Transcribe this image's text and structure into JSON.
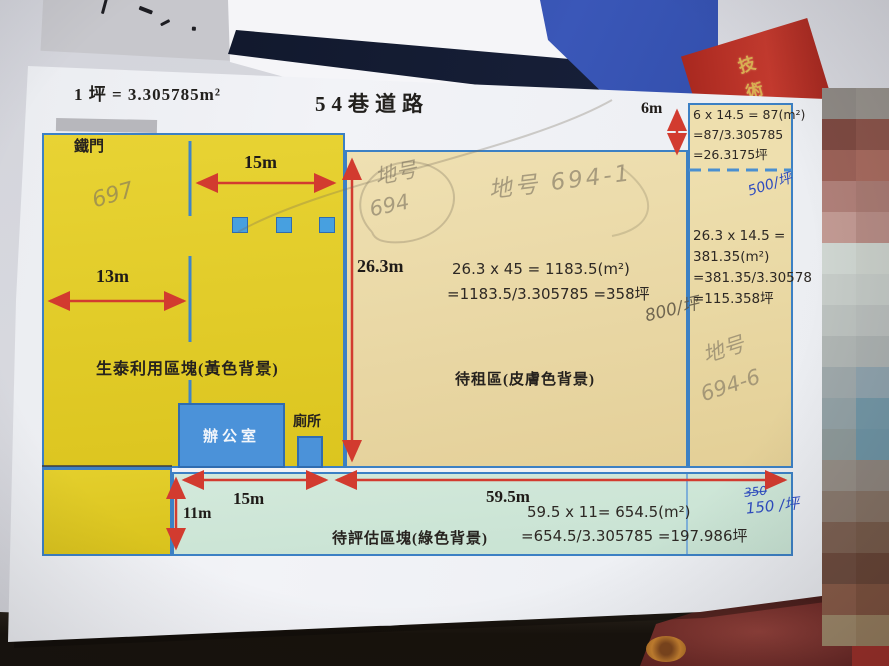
{
  "scene": {
    "banner_text": "技術顧",
    "mosaic_colors": [
      "#8f8a85",
      "#96918b",
      "#7e4a42",
      "#8a544a",
      "#9c6258",
      "#a66a5e",
      "#b08079",
      "#a87a72",
      "#c29a93",
      "#b58b84",
      "#cfd6d1",
      "#c9cfc9",
      "#c6ccc8",
      "#c2c8c4",
      "#bcc2bf",
      "#b8bdbb",
      "#b0b6b4",
      "#abb1b0",
      "#9fa9ab",
      "#8fa3ad",
      "#93a2a6",
      "#7397a6",
      "#8e9a9a",
      "#6e94a4",
      "#958e86",
      "#8e857d",
      "#8a7a6e",
      "#857264",
      "#7d6152",
      "#775b4a",
      "#6e4c3e",
      "#684536",
      "#8a5c48",
      "#7e523e",
      "#a08a6a",
      "#987f5e"
    ]
  },
  "header": {
    "unit_conversion": "1 坪 = 3.305785m²",
    "road_label": "54巷道路"
  },
  "plan": {
    "yellow_region": {
      "gate_label": "鐵門",
      "top_width": "15m",
      "left_width": "13m",
      "area_label": "生泰利用區塊(黃色背景)",
      "office_label": "辦公室",
      "toilet_label": "廁所",
      "hw_lot": "697"
    },
    "middle_region": {
      "height": "26.3m",
      "calc1": "26.3 x 45 = 1183.5(m²)",
      "calc2": "=1183.5/3.305785 =358坪",
      "area_label": "待租區(皮膚色背景)",
      "hw_lot_a1": "地号",
      "hw_lot_a2": "694",
      "hw_lot_b": "地号 694-1",
      "hw_price": "800/坪"
    },
    "right_region": {
      "height": "6m",
      "top_calc1": "6 x 14.5 = 87(m²)",
      "top_calc2": "=87/3.305785",
      "top_calc3": "=26.3175坪",
      "hw_price_top": "500/坪",
      "calc1": "26.3 x 14.5 =",
      "calc2": "381.35(m²)",
      "calc3": "=381.35/3.30578",
      "calc4": "=115.358坪",
      "hw_lot_1": "地号",
      "hw_lot_2": "694-6"
    },
    "green_region": {
      "height": "11m",
      "width_left": "15m",
      "width_right": "59.5m",
      "calc1": "59.5 x 11= 654.5(m²)",
      "calc2": "=654.5/3.305785 =197.986坪",
      "area_label": "待評估區塊(綠色背景)",
      "hw_price_old": "350",
      "hw_price_new": "150 /坪"
    }
  }
}
